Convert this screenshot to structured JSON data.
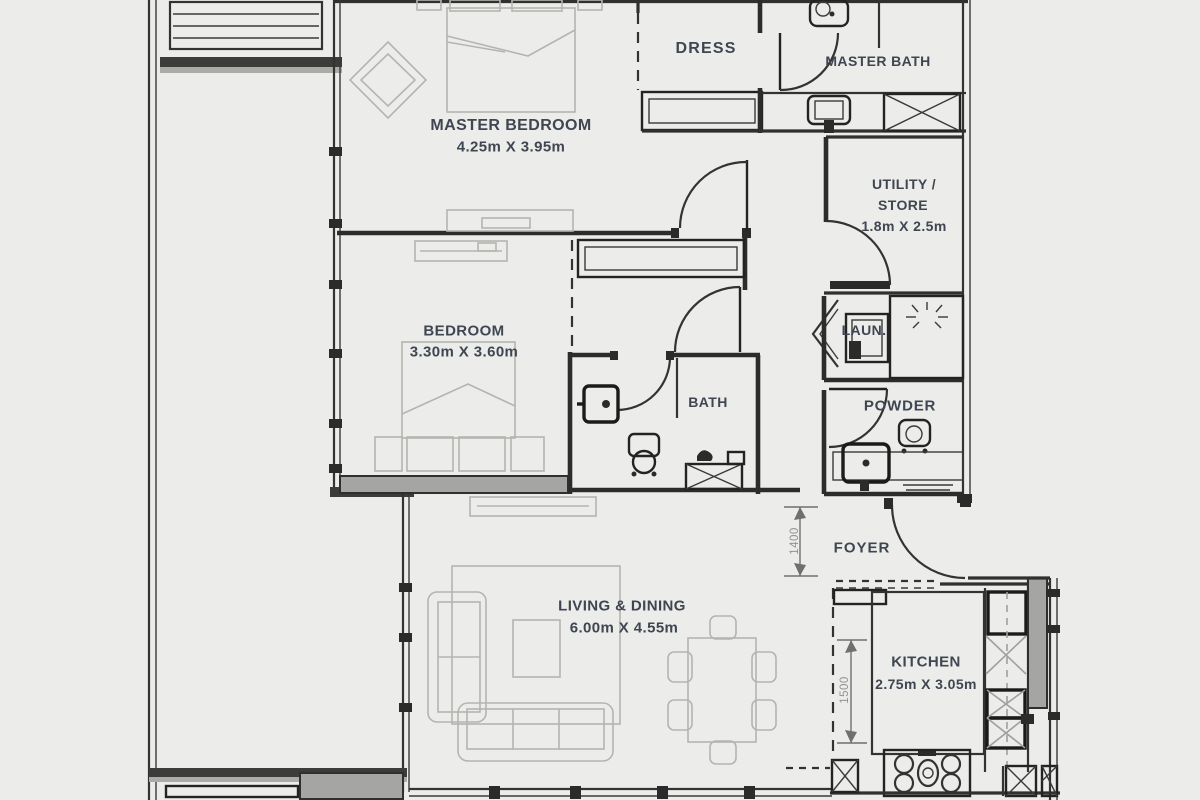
{
  "plan": {
    "rooms": {
      "master_bedroom": {
        "name": "MASTER BEDROOM",
        "dims": "4.25m X 3.95m"
      },
      "dress": {
        "name": "DRESS"
      },
      "master_bath": {
        "name": "MASTER BATH"
      },
      "utility": {
        "name_line1": "UTILITY /",
        "name_line2": "STORE",
        "dims": "1.8m X 2.5m"
      },
      "bedroom": {
        "name": "BEDROOM",
        "dims": "3.30m X 3.60m"
      },
      "bath": {
        "name": "BATH"
      },
      "laundry": {
        "name": "LAUN."
      },
      "powder": {
        "name": "POWDER"
      },
      "foyer": {
        "name": "FOYER"
      },
      "living_dining": {
        "name": "LIVING & DINING",
        "dims": "6.00m X 4.55m"
      },
      "kitchen": {
        "name": "KITCHEN",
        "dims": "2.75m X 3.05m"
      }
    },
    "dimensions": {
      "foyer_depth": "1400",
      "kitchen_width": "1500"
    },
    "colors": {
      "background": "#ECEDEB",
      "wall": "#30302E",
      "furniture": "#B4B5B1",
      "shaded_fill": "#A5A6A3",
      "label_text": "#3F4651",
      "dim_text": "#93948E"
    }
  }
}
